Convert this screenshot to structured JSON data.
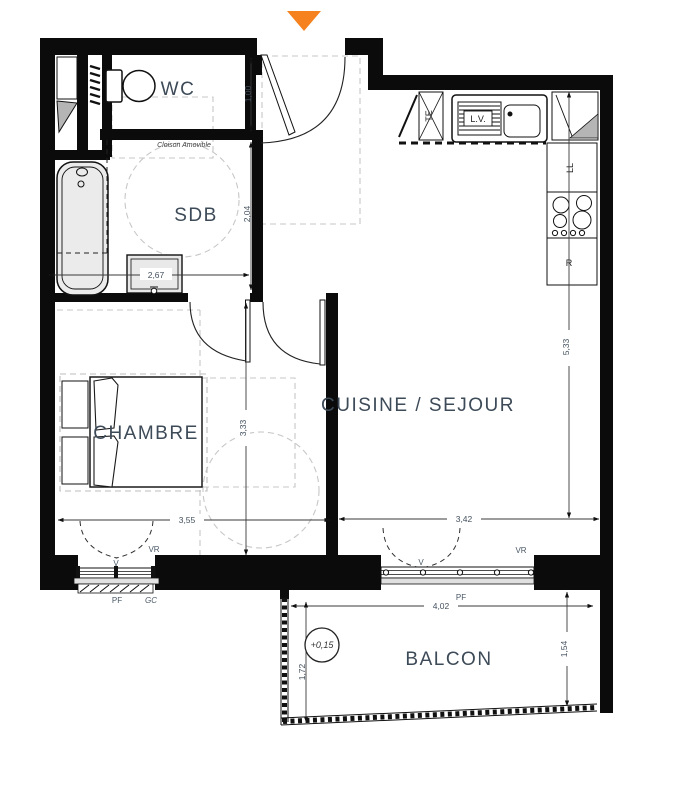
{
  "plan_title": "Floor plan",
  "colors": {
    "entrance_marker": "#F5821F",
    "wall": "#0b0b0b",
    "room_label": "#3d4a57",
    "annotation": "#4a5866"
  },
  "rooms": {
    "wc": "WC",
    "sdb": "SDB",
    "chambre": "CHAMBRE",
    "cuisine_sejour": "CUISINE / SEJOUR",
    "balcon": "BALCON"
  },
  "labels": {
    "cloison_amovible": "Cloison Amovible",
    "level": "+0,15",
    "te": "TE",
    "lv": "L.V.",
    "ll": "LL",
    "refrigerator": "R",
    "vr_chambre": "VR",
    "v_chambre": "V",
    "pf_chambre": "PF",
    "gc_chambre": "GC",
    "vr_sejour": "VR",
    "v_sejour": "V",
    "pf_sejour": "PF"
  },
  "dimensions": {
    "wc_depth": "1,00",
    "sdb_depth": "2,04",
    "sdb_width": "2,67",
    "chambre_depth": "3,33",
    "chambre_width": "3,55",
    "sejour_width": "3,42",
    "sejour_depth": "5,33",
    "balcon_width": "4,02",
    "balcon_depth_left": "1,72",
    "balcon_depth_right": "1,54"
  }
}
